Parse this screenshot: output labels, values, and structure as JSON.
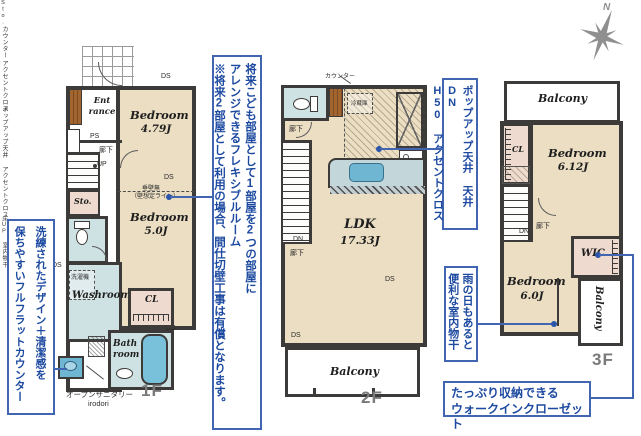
{
  "compass": {
    "north": "N"
  },
  "notes": {
    "counter": {
      "l1": "洗練されたデザイン＋清潔感を",
      "l2": "保ちやすいフルフラットカウンター"
    },
    "flex": {
      "l1": "将来こども部屋として1部屋を2つの部屋に",
      "l2": "アレンジできるフレキシブルルーム",
      "l3": "※将来2部屋として利用の場合、間仕切壁工事は有償となります。"
    },
    "popup": {
      "l1": "ポップアップ天井 天井DN",
      "l2": "H50 アクセントクロス"
    },
    "drying": {
      "l1": "雨の日もあると",
      "l2": "便利な室内物干"
    },
    "wic": {
      "l1": "たっぷり収納できる",
      "l2": "ウォークインクローゼット"
    }
  },
  "f1": {
    "floor": "1F",
    "entrance": "Ent rance",
    "ps": "PS",
    "hall": "廊下",
    "up": "UP",
    "sto_small": "Sto.",
    "sto": "Sto.",
    "counter_v": "カウンター",
    "ds": "DS",
    "washer": "洗濯機",
    "washroom": "Washroom",
    "accent_v": "アクセントクロス",
    "bath1": "Bath",
    "bath2": "room",
    "open1": "オープンサニタリー",
    "open2": "irodori",
    "bed1": "Bedroom",
    "bed1_size": "4.79J",
    "wall1": "垂壁無",
    "wall2": "（壁想定ライン）",
    "bed2": "Bedroom",
    "bed2_size": "5.0J",
    "cl": "CL"
  },
  "f2": {
    "floor": "2F",
    "counter_lbl": "カウンター",
    "fridge": "冷蔵庫",
    "hall_top": "廊下",
    "up": "UP",
    "dn": "DN",
    "hall_btm": "廊下",
    "accent_v": "アクセントクロス",
    "popup_v": "ポップアップ天井",
    "ldk": "LDK",
    "ldk_size": "17.33J",
    "ds": "DS",
    "balcony": "Balcony"
  },
  "f3": {
    "floor": "3F",
    "balcony_top": "Balcony",
    "cl": "CL",
    "bed1": "Bedroom",
    "bed1_size": "6.12J",
    "floor_up": "床UP",
    "dn": "DN",
    "hall": "廊下",
    "wic": "WIC",
    "bed2": "Bedroom",
    "bed2_size": "6.0J",
    "drying_v": "室内物干",
    "balcony_right": "Balcony"
  }
}
